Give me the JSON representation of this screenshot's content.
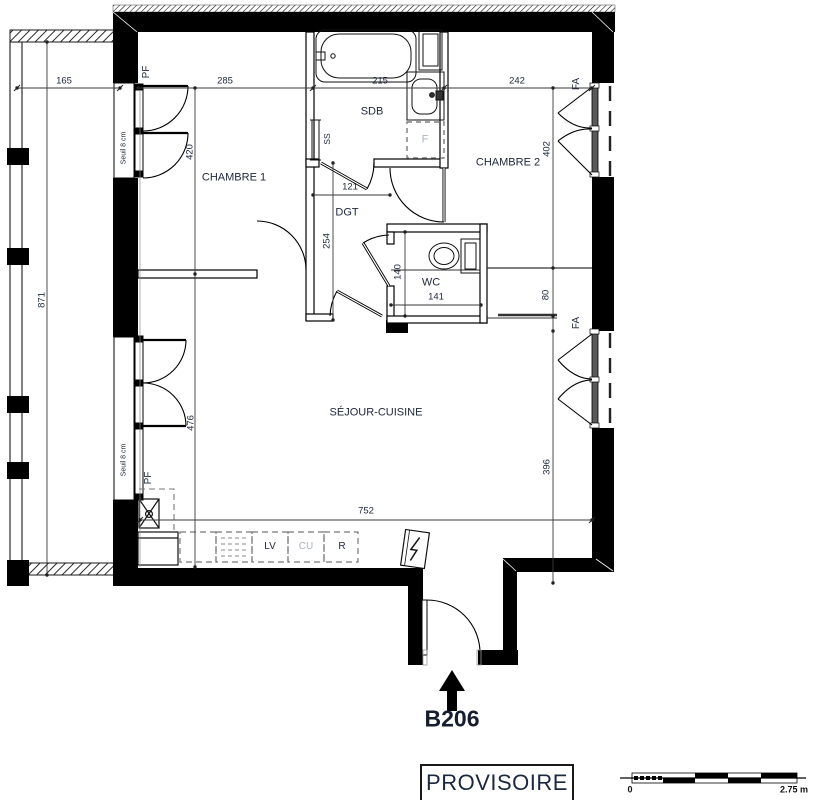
{
  "unit": {
    "label": "B206",
    "stamp": "PROVISOIRE"
  },
  "rooms": {
    "chambre1": "CHAMBRE 1",
    "chambre2": "CHAMBRE 2",
    "sdb": "SDB",
    "dgt": "DGT",
    "wc": "WC",
    "sejour": "SÉJOUR-CUISINE"
  },
  "openings": {
    "pf1": "PF",
    "pf2": "PF",
    "fa1": "FA",
    "fa2": "FA",
    "seuil1": "Seuil 8 cm",
    "seuil2": "Seuil 8 cm",
    "ss": "SS"
  },
  "appliances": {
    "lv": "LV",
    "cu": "CU",
    "r": "R",
    "f": "F"
  },
  "dims": {
    "d165": "165",
    "d285": "285",
    "d215": "215",
    "d242": "242",
    "d871": "871",
    "d420": "420",
    "d476": "476",
    "d402": "402",
    "d80": "80",
    "d396": "396",
    "d121": "121",
    "d254": "254",
    "d140": "140",
    "d141": "141",
    "d752": "752"
  },
  "scale_bar": {
    "start": "0",
    "end": "2.75 m"
  },
  "colors": {
    "ink": "#202a3d",
    "muted": "#aab3c2",
    "wall": "#000000"
  }
}
